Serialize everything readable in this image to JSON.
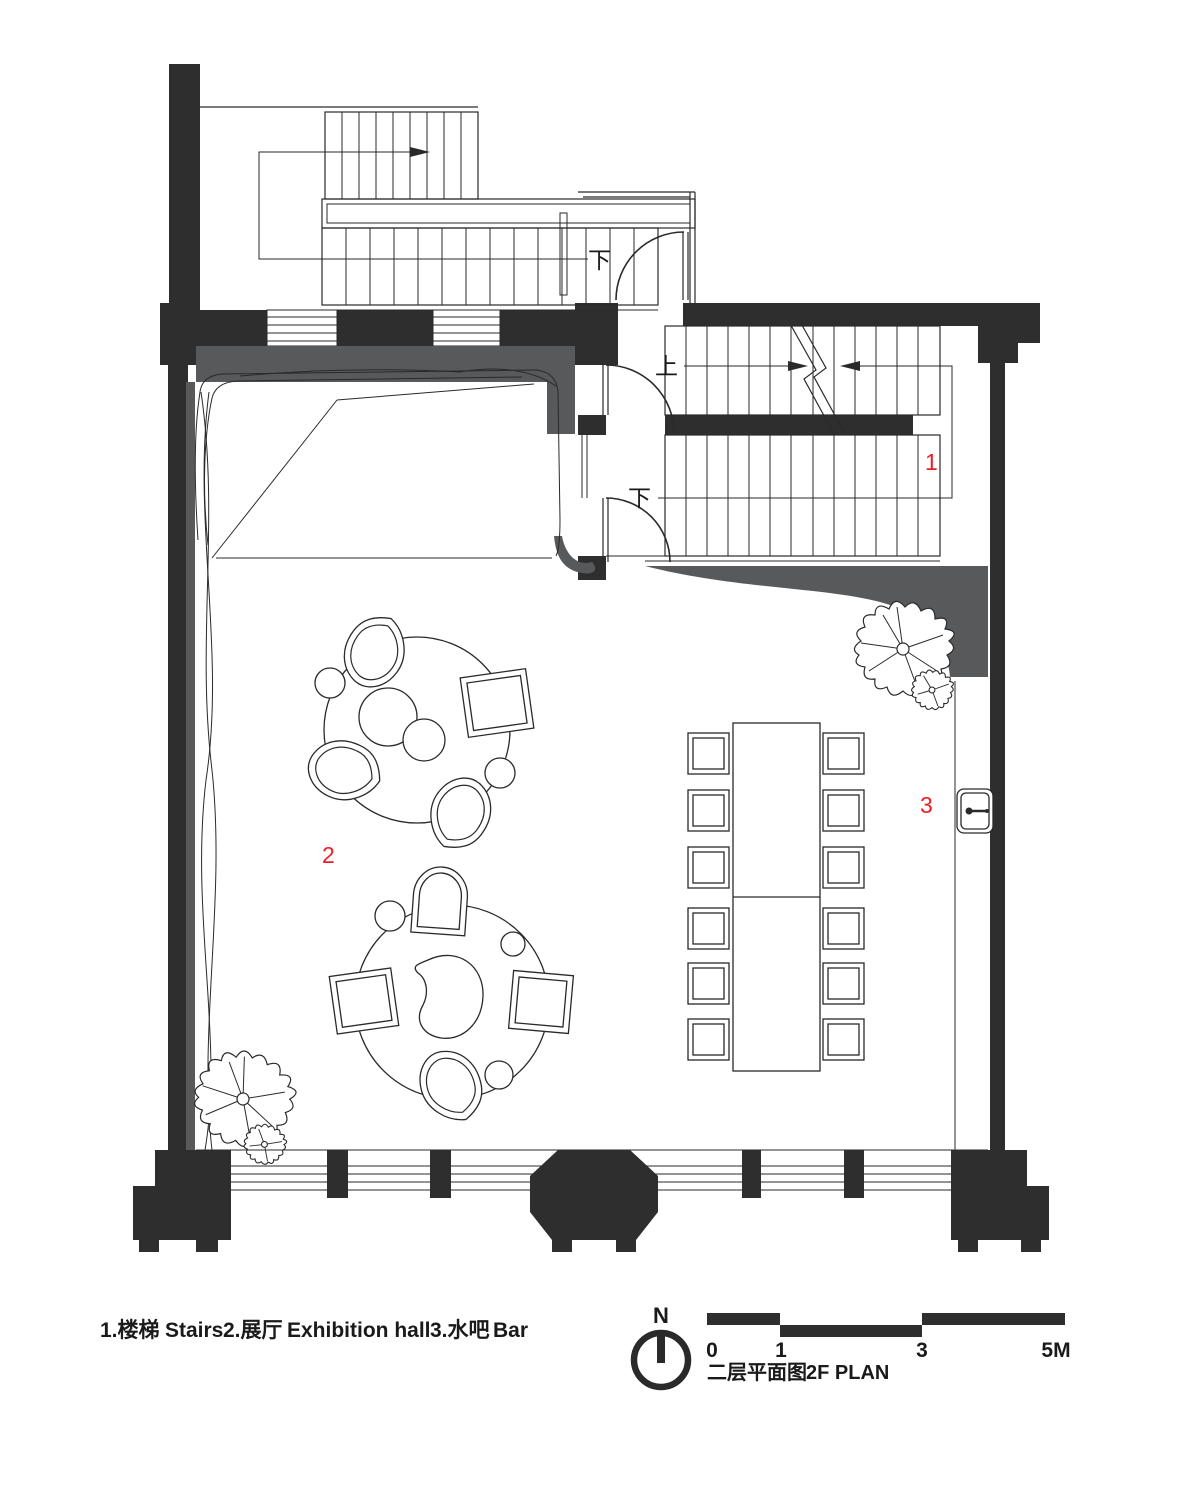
{
  "title": {
    "zh": "二层平面图",
    "en": "2F PLAN"
  },
  "north": {
    "label": "N"
  },
  "scale_bar": {
    "ticks": [
      "0",
      "1",
      "3",
      "5M"
    ]
  },
  "legend": {
    "items": [
      {
        "label": "1.楼梯",
        "name": "Stairs"
      },
      {
        "label": "2.展厅",
        "name": "Exhibition hall"
      },
      {
        "label": "3.水吧",
        "name": "Bar"
      }
    ]
  },
  "room_numbers": {
    "stairs": "1",
    "exhibition_hall": "2",
    "bar": "3"
  },
  "stair_annotations": {
    "up": "上",
    "down_main": "下",
    "down_upper": "下"
  },
  "colors": {
    "wall": "#2e2e2f",
    "soffit_gray": "#58595b",
    "accent_red": "#ee1c25",
    "line": "#2a2a2b"
  }
}
